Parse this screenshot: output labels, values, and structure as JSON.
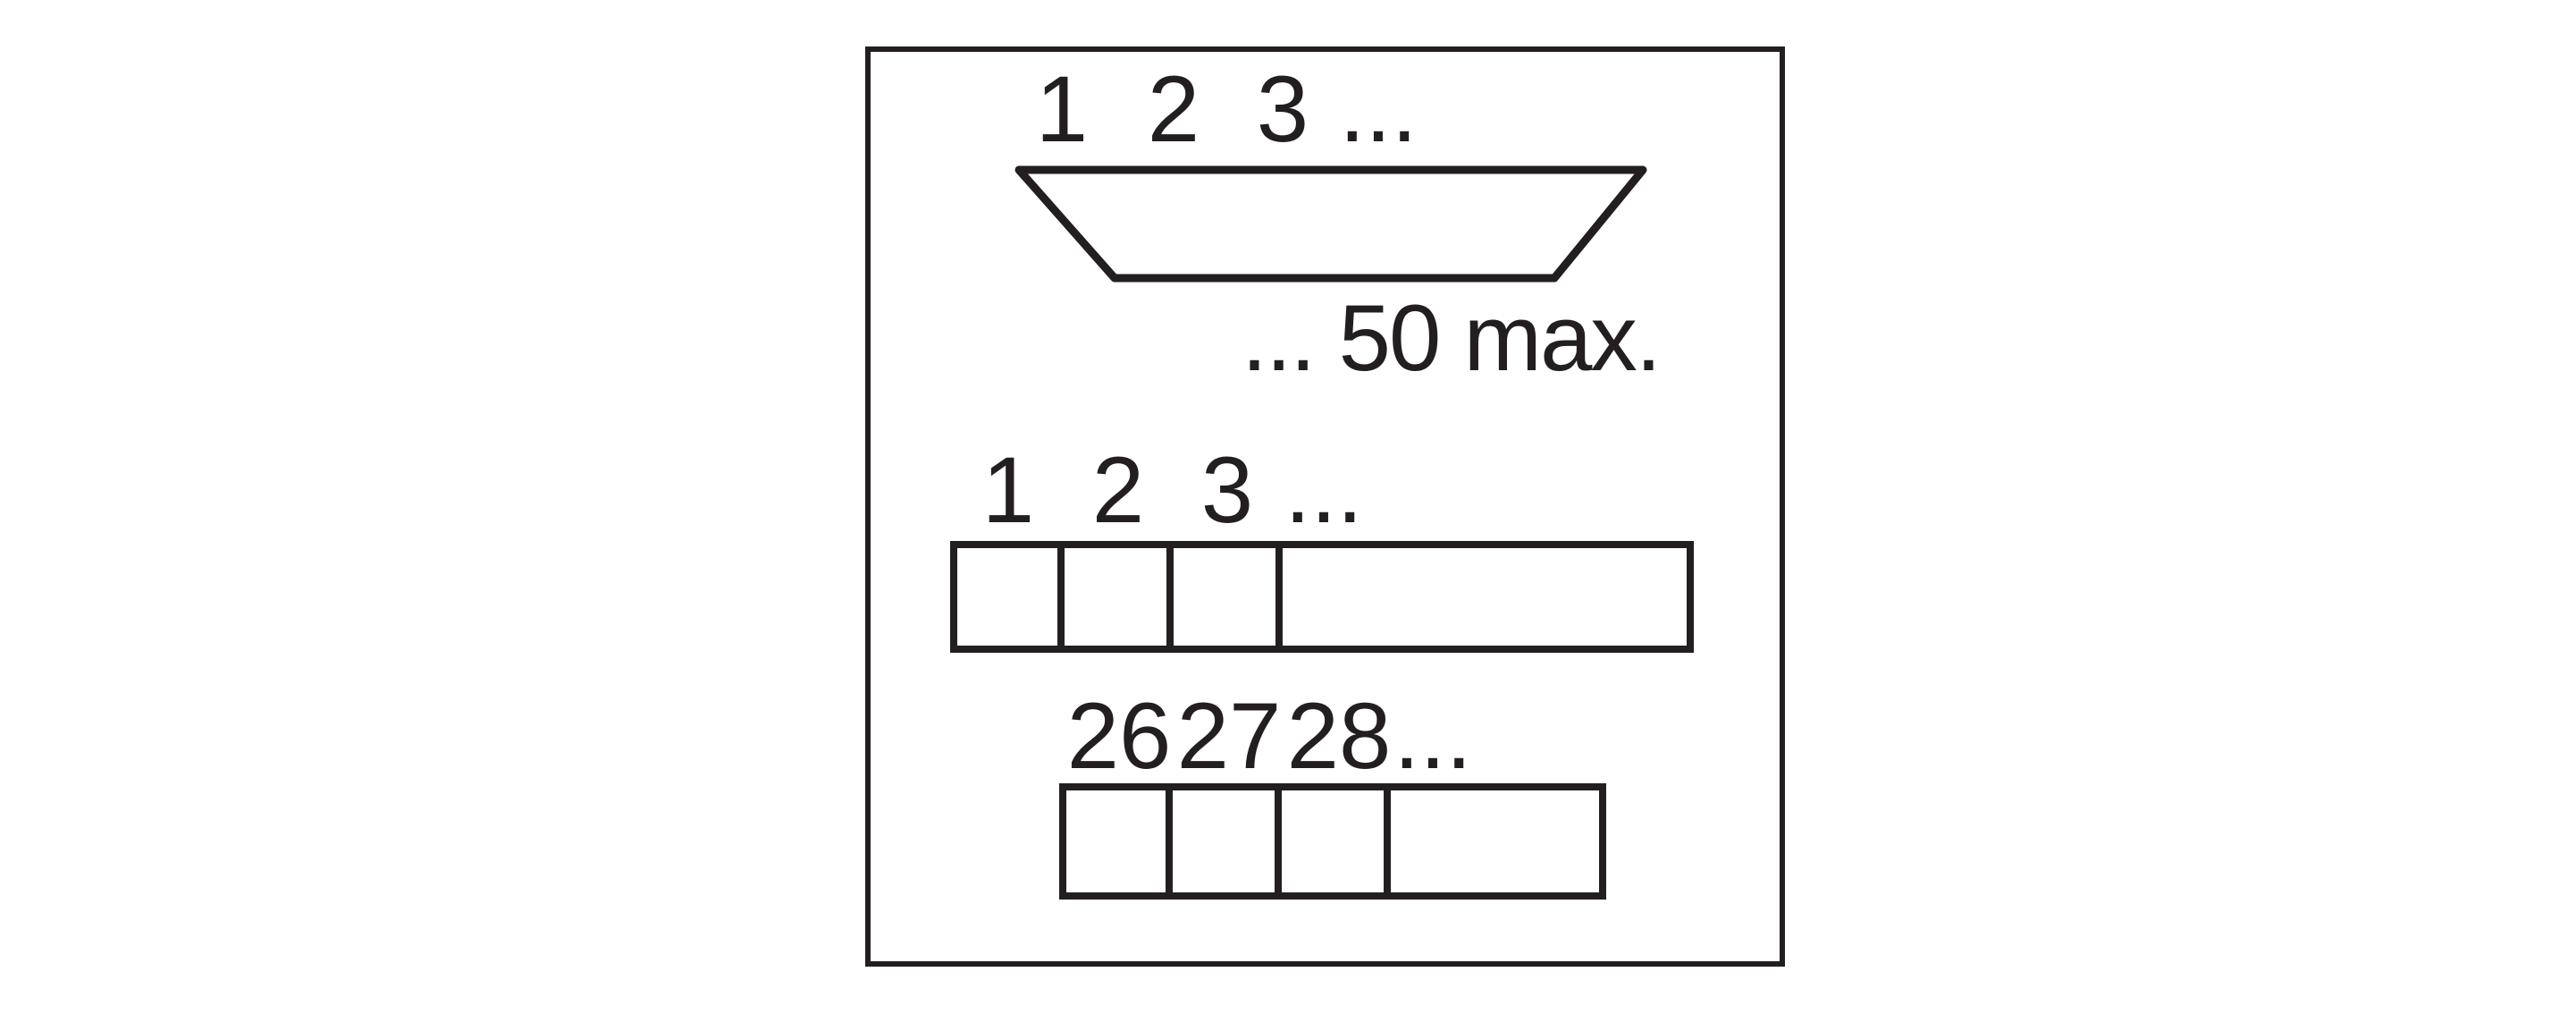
{
  "canvas": {
    "background_color": "#ffffff",
    "line_color": "#231f20"
  },
  "connector": {
    "pins": [
      "1",
      "2",
      "3",
      "..."
    ],
    "max_label": "... 50 max."
  },
  "marker_strip_top": {
    "pins": [
      "1",
      "2",
      "3",
      "..."
    ]
  },
  "marker_strip_bottom": {
    "pins": [
      "26",
      "27",
      "28",
      "..."
    ]
  }
}
